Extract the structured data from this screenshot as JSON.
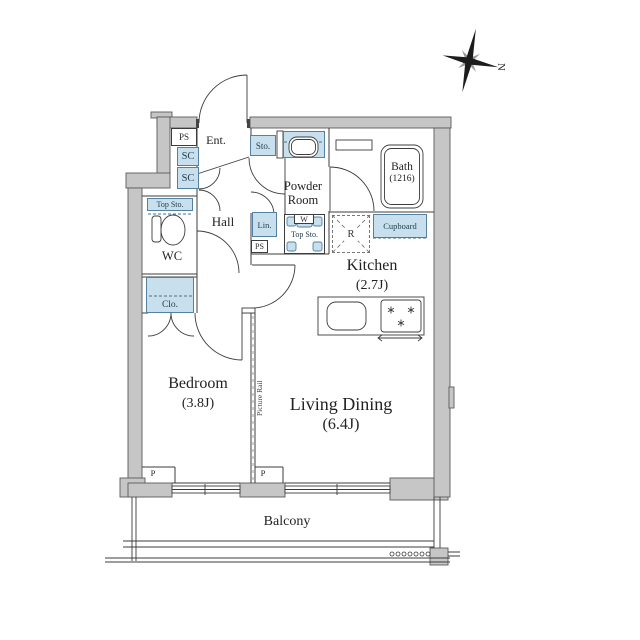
{
  "compass": {
    "north": "N"
  },
  "rooms": {
    "entrance": {
      "label": "Ent."
    },
    "hall": {
      "label": "Hall"
    },
    "wc": {
      "label": "WC"
    },
    "powder_room": {
      "line1": "Powder",
      "line2": "Room"
    },
    "bath": {
      "label": "Bath",
      "size": "(1216)"
    },
    "kitchen": {
      "label": "Kitchen",
      "size": "(2.7J)"
    },
    "living_dining": {
      "label": "Living Dining",
      "size": "(6.4J)"
    },
    "bedroom": {
      "label": "Bedroom",
      "size": "(3.8J)"
    },
    "balcony": {
      "label": "Balcony"
    }
  },
  "fixtures": {
    "ps_top": "PS",
    "sc_upper": "SC",
    "sc_lower": "SC",
    "wc_top_storage": "Top Sto.",
    "closet": "Clo.",
    "entry_storage": "Sto.",
    "linen": "Lin.",
    "ps_small": "PS",
    "washer": "W",
    "washer_top_storage": "Top Sto.",
    "cupboard": "Cupboard",
    "refrigerator": "R",
    "picture_rail": "Picture Rail",
    "pillar_bedroom": "P",
    "pillar_living": "P"
  },
  "colors": {
    "storage_fill": "#c8e0ee",
    "storage_border": "#55809f",
    "wall_fill": "#c6c6c6",
    "wall_outline": "#5a5a5a",
    "line": "#3c3c3c"
  }
}
